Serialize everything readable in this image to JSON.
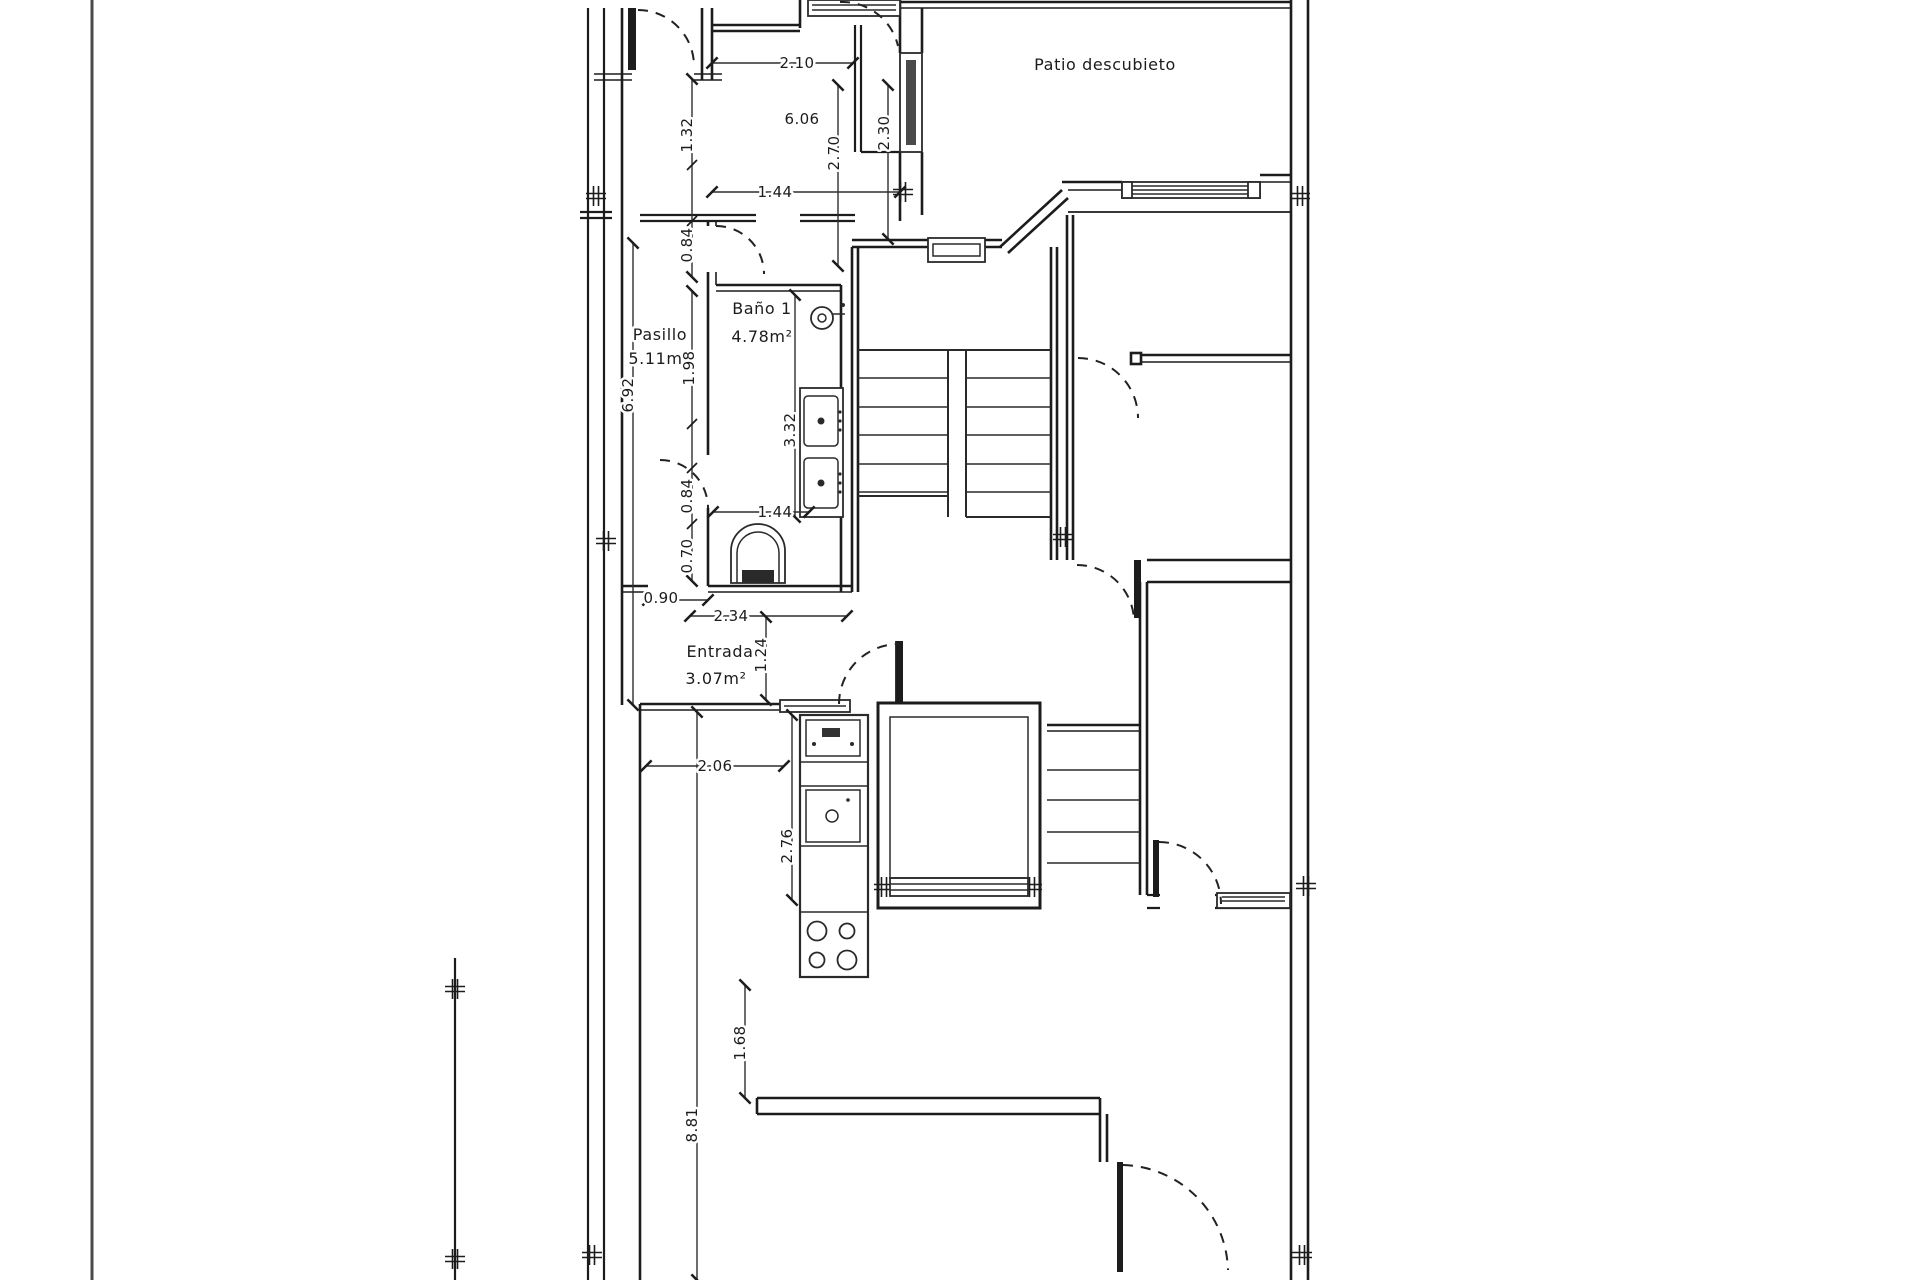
{
  "colors": {
    "ink": "#1c1c1c",
    "paper": "#ffffff",
    "frame": "#4a4a4a"
  },
  "labels": {
    "patio": "Patio descubieto",
    "bathroom_name": "Baño 1",
    "bathroom_area": "4.78m²",
    "hallway_name": "Pasillo",
    "hallway_area": "5.11m²",
    "entry_name": "Entrada",
    "entry_area": "3.07m²"
  },
  "dims": {
    "top_room_width": "2.10",
    "top_room_area": "6.06",
    "top_room_height_left": "2.70",
    "top_room_height_right": "2.30",
    "top_opening": "1.44",
    "corridor_seg1": "1.32",
    "corridor_seg2": "0.84",
    "corridor_length": "6.92",
    "bath_seg1": "1.98",
    "bath_length": "3.32",
    "bath_seg2": "0.84",
    "bath_opening": "1.44",
    "bath_seg3": "0.70",
    "corridor_opening": "0.90",
    "bath_width": "2.34",
    "entry_depth": "1.24",
    "kitchen_width": "2.06",
    "kitchen_counter": "2.76",
    "kitchen_wall": "1.68",
    "lower_length": "8.81"
  }
}
